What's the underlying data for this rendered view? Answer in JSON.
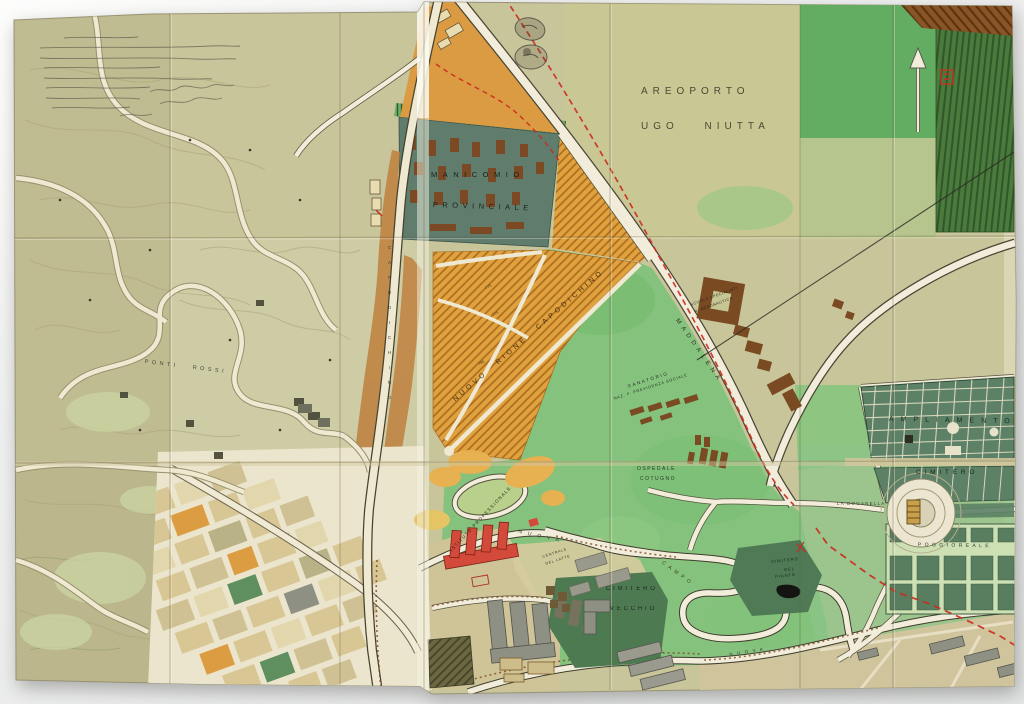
{
  "scene": {
    "description": "Hand-drawn town-planning map (Capodichino / Poggioreale area, Naples) photographed on a light backdrop",
    "palette": {
      "backdrop": "#eef0ef",
      "paper": "#c8c59a",
      "field_green": "#85c27d",
      "dark_green_hatch": "#4a7a3c",
      "cemetery_green": "#5c8166",
      "zone_orange": "#e0a23f",
      "corridor_brown": "#bf7f3e",
      "building_brown": "#7a4a22",
      "building_red": "#d3493a",
      "building_gray": "#8f9084",
      "road_white": "#f2eddb",
      "route_red": "#cc2b1f",
      "manicomio_slate": "#5f7c6d"
    },
    "labels": {
      "areoporto_line1": "AREOPORTO",
      "areoporto_line2": "UGO NIUTTA",
      "manicomio_line1": "MANICOMIO",
      "manicomio_line2": "PROVINCIALE",
      "nuovo_rione": "NUOVO RIONE CAPODICHINO",
      "scuola_line1": "SCUOLA SPECIALISTI",
      "scuola_line2": "R. AERONAUTICA",
      "sanatorio_line1": "SANATORIO",
      "sanatorio_line2": "NAZ. F. PREVIDENZA SOCIALE",
      "ospedale_line1": "OSPEDALE",
      "ospedale_line2": "COTUGNO",
      "cimitero_vecchio_line1": "CIMITERO",
      "cimitero_vecchio_line2": "VECCHIO",
      "cimitero_pianto_line1": "CIMITERO",
      "cimitero_pianto_line2": "DEL",
      "cimitero_pianto_line3": "PIANTO",
      "la_doganella": "LA DOGANELLA",
      "ampliamento": "AMPLIAMENTO",
      "cimitero_nuovo": "CIMITERO",
      "poggioreale": "POGGIOREALE",
      "istituto": "ISTITUTO PROFESSIONALE",
      "centrale_line1": "CENTRALE",
      "centrale_line2": "DEL LATTE",
      "ponti_rossi": "PONTI ROSSI"
    },
    "road_labels": {
      "maddalena": "MADDALENA",
      "capodichino": "CAPODICHINO",
      "campo": "CAMPO",
      "nuova_1": "NUOVA",
      "nuova_2": "NUOVA"
    },
    "lot_numbers": {
      "a": "775",
      "b": "774",
      "c": "785"
    }
  }
}
